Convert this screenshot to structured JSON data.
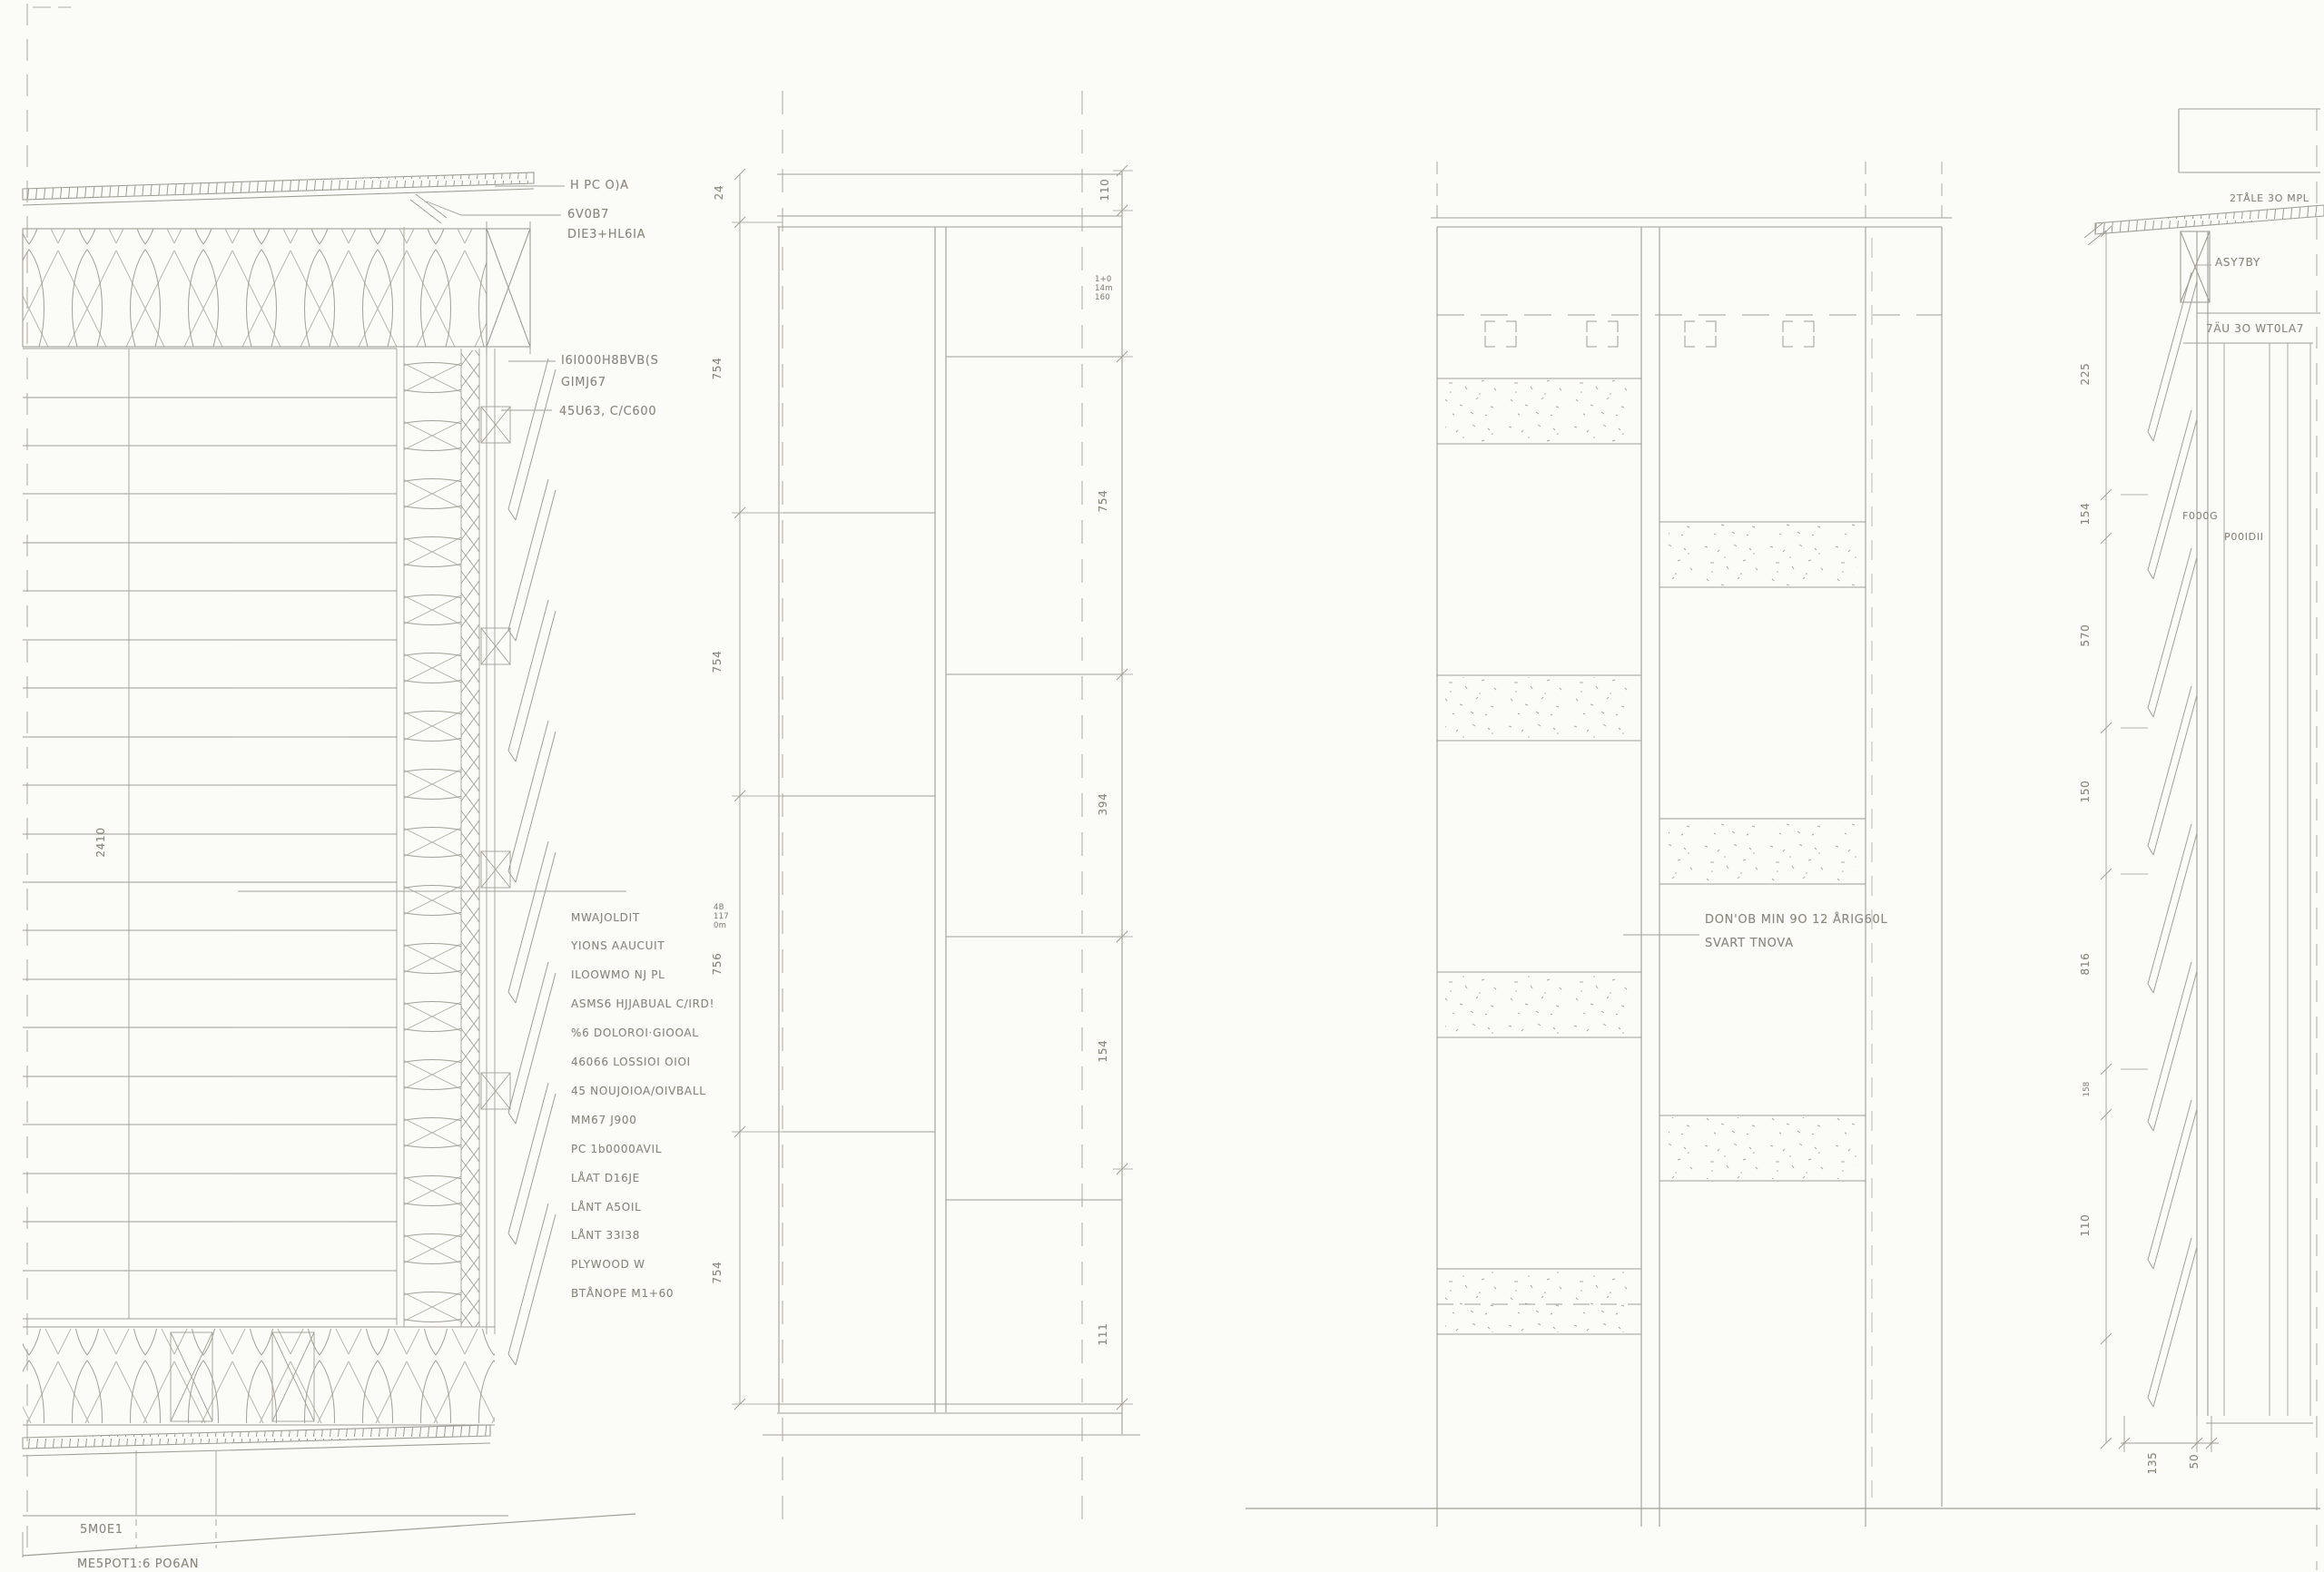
{
  "sheet": {
    "paper_color": "#fbfbf8",
    "pencil_color": "#98978d",
    "text_color": "#8b897e"
  },
  "left_detail": {
    "dim_vertical": "2410",
    "annotations": {
      "top1": "H PC O)A",
      "top2": "6V0B7",
      "top3": "DIE3+HL6IA",
      "mid1": "I6I000H8BVB(S",
      "mid2": "GIMJ67",
      "mid3": "45U63, C/C600"
    },
    "note_block": [
      "MWAJOLDIT",
      "YIONS AAUCUIT",
      "ILOOWMO NJ PL",
      "ASMS6 HJJABUAL C/IRD!",
      "%6 DOLOROI·GIOOAL",
      "46066 LOSSIOI OIOI",
      "45 NOUJOIOA/OIVBALL",
      "MM67 J900",
      "PC 1b0000AVIL",
      "LÅAT D16JE",
      "LÅNT A5OIL",
      "LÅNT 33I38",
      "PLYWOOD W",
      "BTÅNOPE M1+60"
    ],
    "ground1": "5M0E1",
    "ground2": "ME5POT1:6 PO6AN"
  },
  "elev_left": {
    "dims_left": [
      "24",
      "754",
      "754",
      "756",
      "754"
    ],
    "tiny_left": "4B\n117\n0m",
    "dims_right": [
      "110",
      "754",
      "394",
      "154",
      "111"
    ],
    "tiny_right": "1+0\n14m\n160"
  },
  "elev_right": {
    "note1": "DON'OB MIN 9O 12 ÅRIG60L",
    "note2": "SVART TNOVA"
  },
  "right_detail": {
    "top_note": "2TÅLE 3O MPL",
    "ann1": "ASY7BY",
    "ann2": "7ÄU 3O WT0LA7",
    "foder1": "F000G",
    "foder2": "P00IDII",
    "dims_left": [
      "225",
      "154",
      "570",
      "150",
      "816",
      "158",
      "110"
    ],
    "dims_bottom": [
      "135",
      "50"
    ]
  }
}
